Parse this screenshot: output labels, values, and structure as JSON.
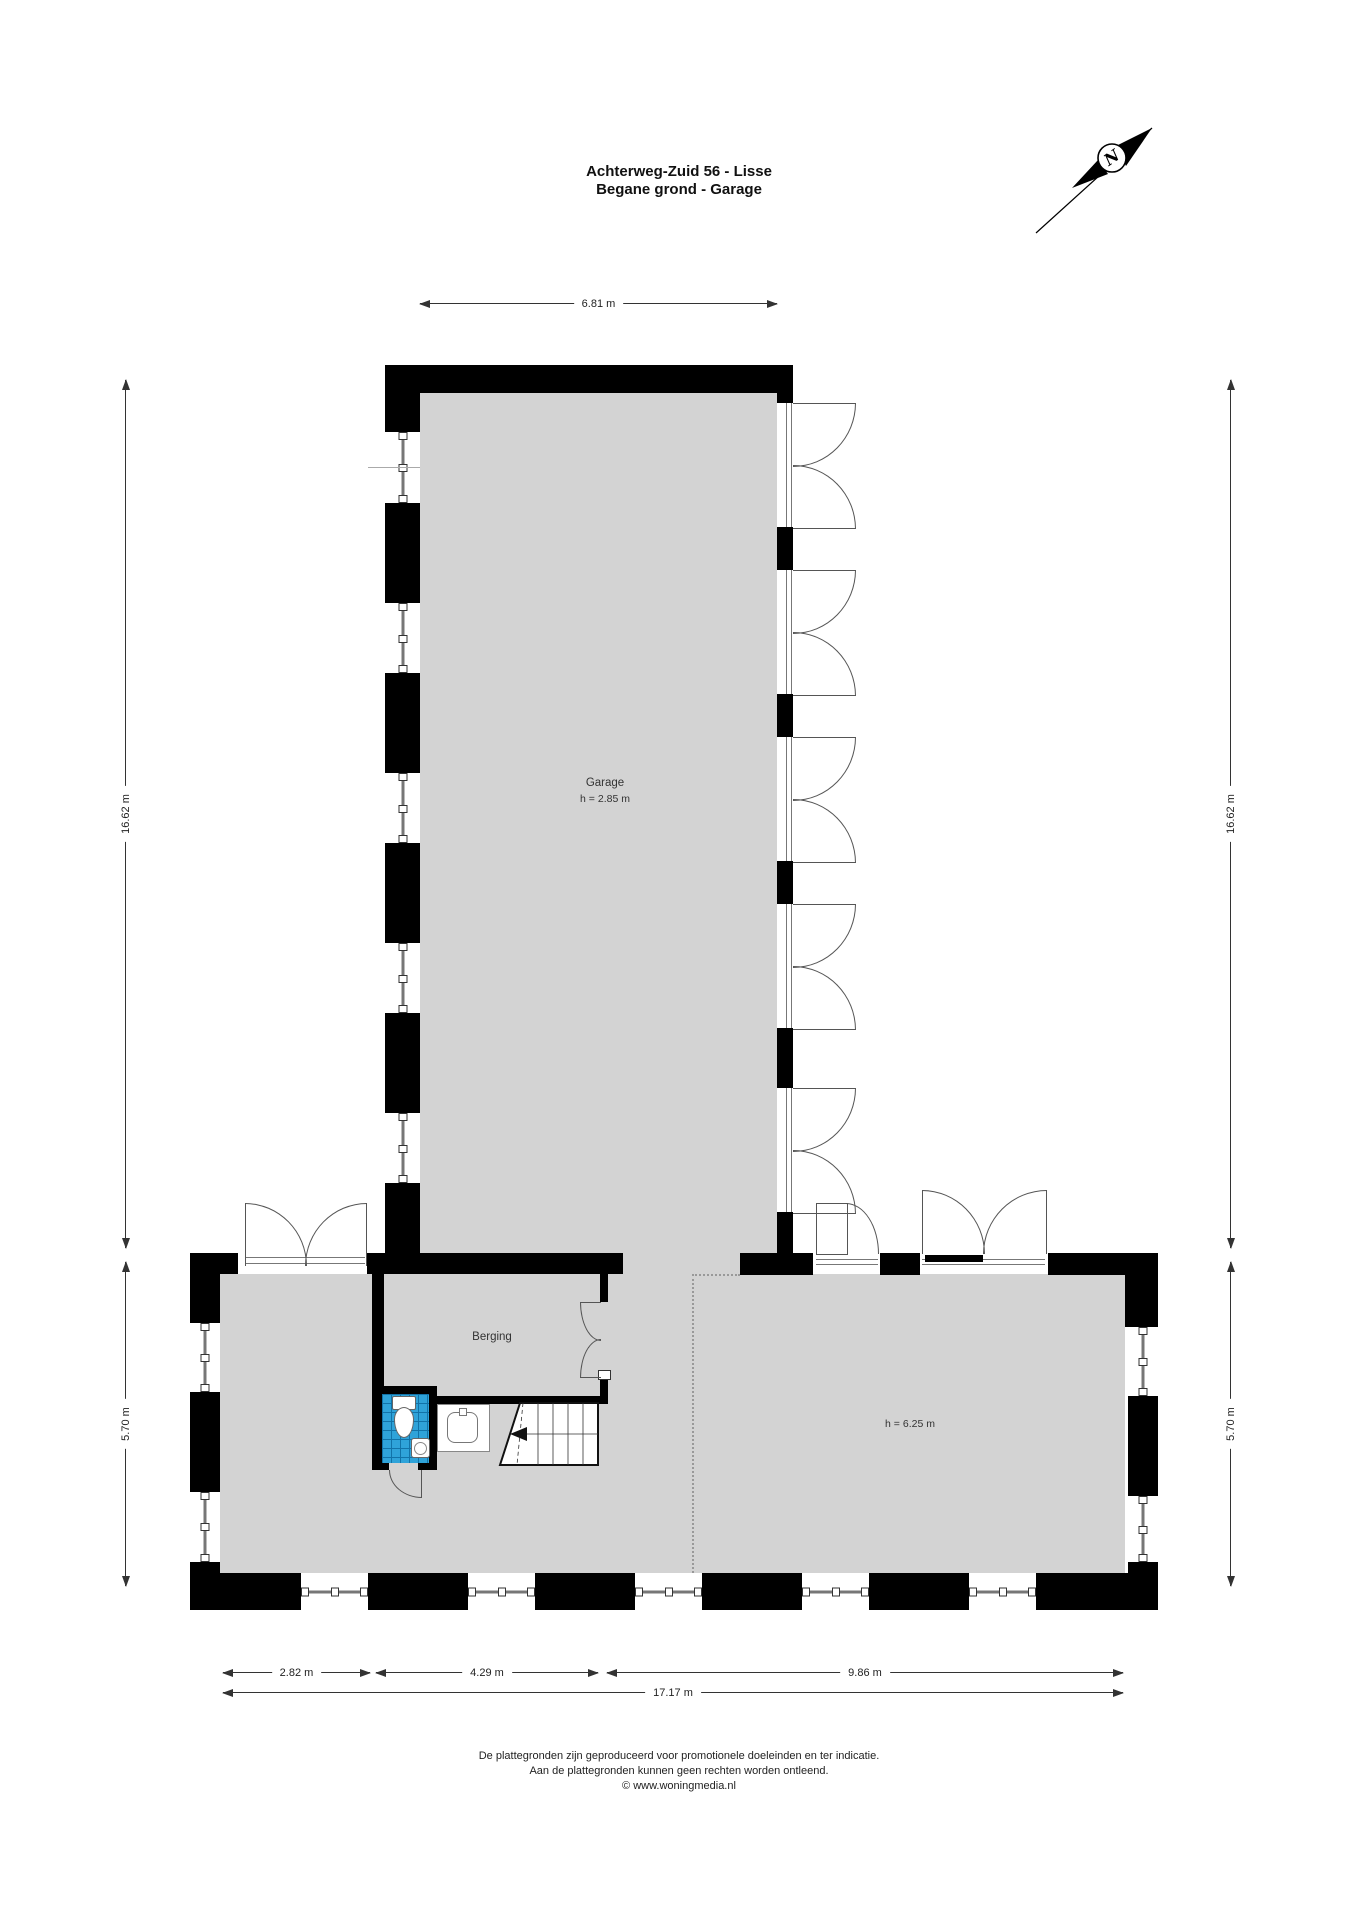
{
  "title": {
    "line1": "Achterweg-Zuid 56 - Lisse",
    "line2": "Begane grond - Garage"
  },
  "compass": {
    "label": "N"
  },
  "rooms": {
    "garage": {
      "name": "Garage",
      "height": "h = 2.85 m"
    },
    "berging": {
      "name": "Berging"
    },
    "main_hall": {
      "height": "h = 6.25 m"
    }
  },
  "dimensions": {
    "top": "6.81 m",
    "left_upper": "16.62 m",
    "left_lower": "5.70 m",
    "right_upper": "16.62 m",
    "right_lower": "5.70 m",
    "bottom_segments": [
      "2.82 m",
      "4.29 m",
      "9.86 m"
    ],
    "bottom_total": "17.17 m"
  },
  "footer": {
    "line1": "De plattegronden zijn geproduceerd voor promotionele doeleinden en ter indicatie.",
    "line2": "Aan de plattegronden kunnen geen rechten worden ontleend.",
    "line3": "© www.woningmedia.nl"
  },
  "colors": {
    "floor": "#d3d3d3",
    "wall": "#000000",
    "tile_blue": "#2fa3d9",
    "line": "#555555"
  }
}
